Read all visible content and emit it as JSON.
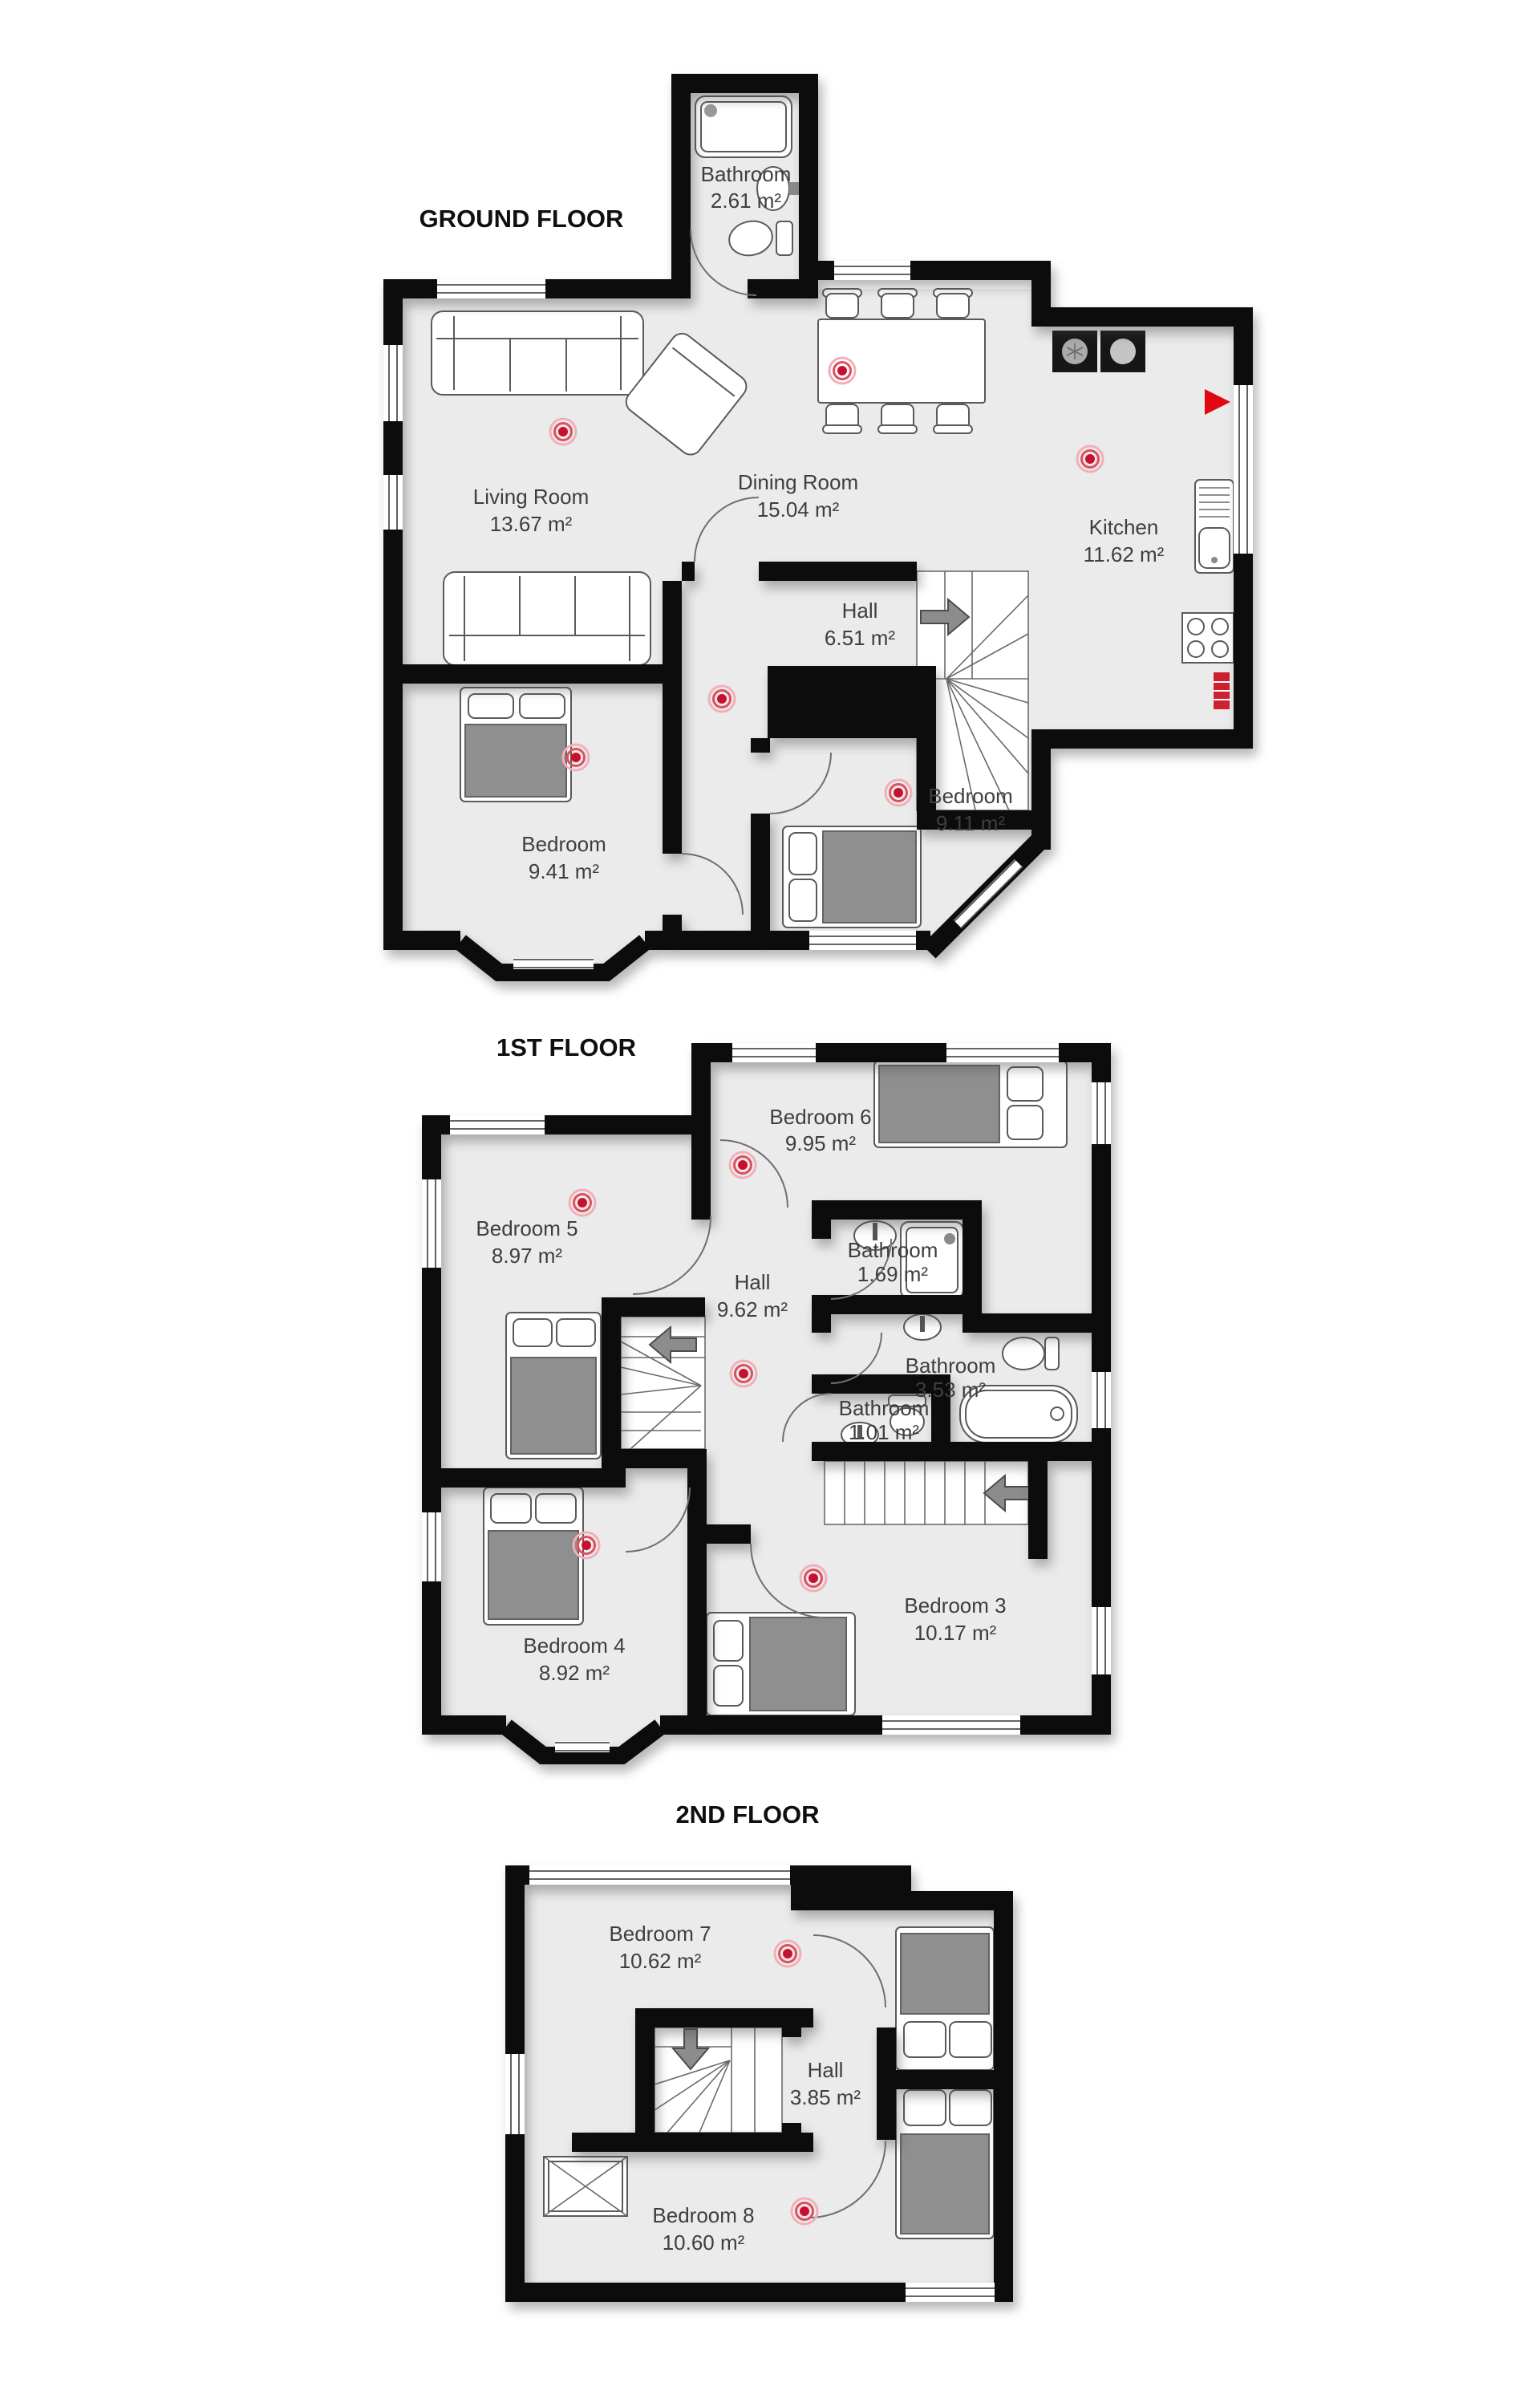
{
  "colors": {
    "wall": "#0c0c0c",
    "floor_fill": "#ebebeb",
    "furniture_stroke": "#5a5a5a",
    "bed_blanket": "#8f8f8f",
    "label_text": "#3e3e3e",
    "title_text": "#0f0f0f",
    "smoke_detector_red": "#c8102e",
    "stair_arrow": "#8c8c8c",
    "entrance_marker_red": "#e30613"
  },
  "floors": {
    "ground": {
      "title": "GROUND FLOOR",
      "rooms": {
        "bathroom": {
          "name": "Bathroom",
          "area": "2.61 m²"
        },
        "living": {
          "name": "Living Room",
          "area": "13.67 m²"
        },
        "dining": {
          "name": "Dining Room",
          "area": "15.04 m²"
        },
        "kitchen": {
          "name": "Kitchen",
          "area": "11.62 m²"
        },
        "hall": {
          "name": "Hall",
          "area": "6.51 m²"
        },
        "bedroom_left": {
          "name": "Bedroom",
          "area": "9.41 m²"
        },
        "bedroom_right": {
          "name": "Bedroom",
          "area": "9.11 m²"
        }
      }
    },
    "first": {
      "title": "1ST FLOOR",
      "rooms": {
        "bedroom6": {
          "name": "Bedroom 6",
          "area": "9.95 m²"
        },
        "bedroom5": {
          "name": "Bedroom 5",
          "area": "8.97 m²"
        },
        "hall": {
          "name": "Hall",
          "area": "9.62 m²"
        },
        "bathroom_top": {
          "name": "Bathroom",
          "area": "1.69 m²"
        },
        "bathroom_mid": {
          "name": "Bathroom",
          "area": "3.53 m²"
        },
        "bathroom_small": {
          "name": "Bathroom",
          "area": "1.01 m²"
        },
        "bedroom3": {
          "name": "Bedroom 3",
          "area": "10.17 m²"
        },
        "bedroom4": {
          "name": "Bedroom 4",
          "area": "8.92 m²"
        }
      }
    },
    "second": {
      "title": "2ND FLOOR",
      "rooms": {
        "bedroom7": {
          "name": "Bedroom 7",
          "area": "10.62 m²"
        },
        "hall": {
          "name": "Hall",
          "area": "3.85 m²"
        },
        "bedroom8": {
          "name": "Bedroom 8",
          "area": "10.60 m²"
        }
      }
    }
  }
}
